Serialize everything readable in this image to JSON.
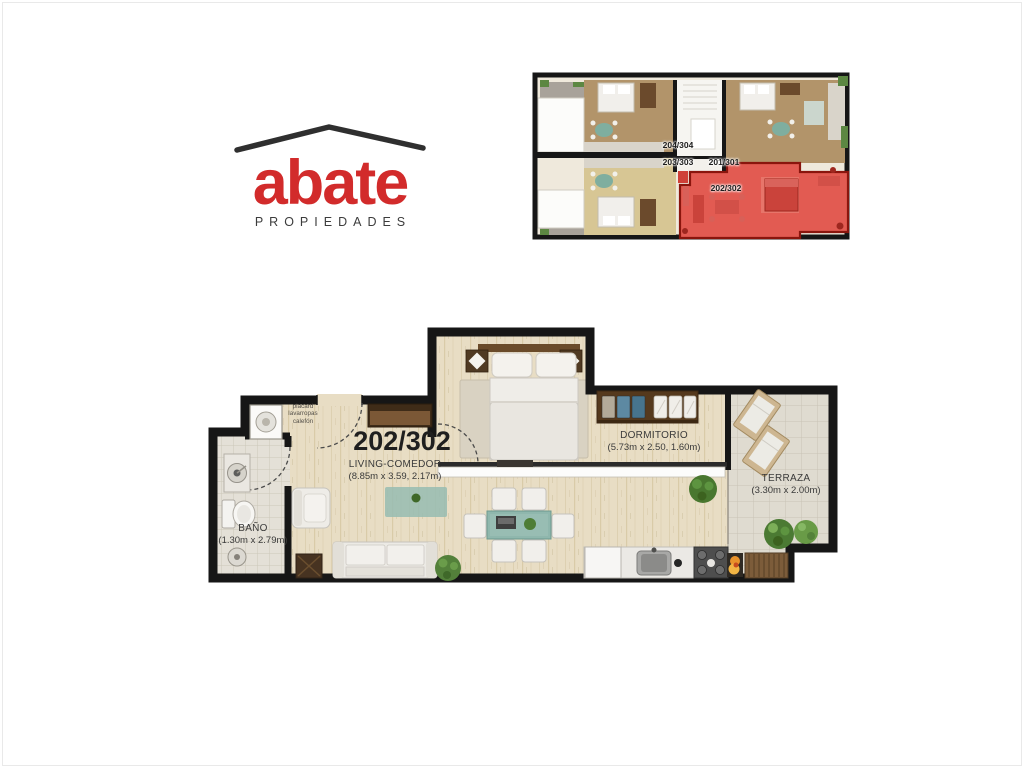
{
  "brand": {
    "name": "abate",
    "tagline": "PROPIEDADES",
    "accent_color": "#d22b2b",
    "roof_color": "#2f2f2f"
  },
  "overview": {
    "units": [
      {
        "id": "204/304",
        "highlighted": false
      },
      {
        "id": "203/303",
        "highlighted": false
      },
      {
        "id": "201/301",
        "highlighted": false
      },
      {
        "id": "202/302",
        "highlighted": true
      }
    ],
    "highlight_color": "#e25b52"
  },
  "floorplan": {
    "unit_label": "202/302",
    "rooms": [
      {
        "name": "LIVING-COMEDOR",
        "dims": "(8.85m x 3.59, 2.17m)"
      },
      {
        "name": "DORMITORIO",
        "dims": "(5.73m x 2.50, 1.60m)"
      },
      {
        "name": "TERRAZA",
        "dims": "(3.30m x 2.00m)"
      },
      {
        "name": "BAÑO",
        "dims": "(1.30m x 2.79m)"
      }
    ],
    "utility_note": {
      "line1": "placard",
      "line2": "lavarropas",
      "line3": "calefón"
    },
    "wall_color": "#161616"
  }
}
